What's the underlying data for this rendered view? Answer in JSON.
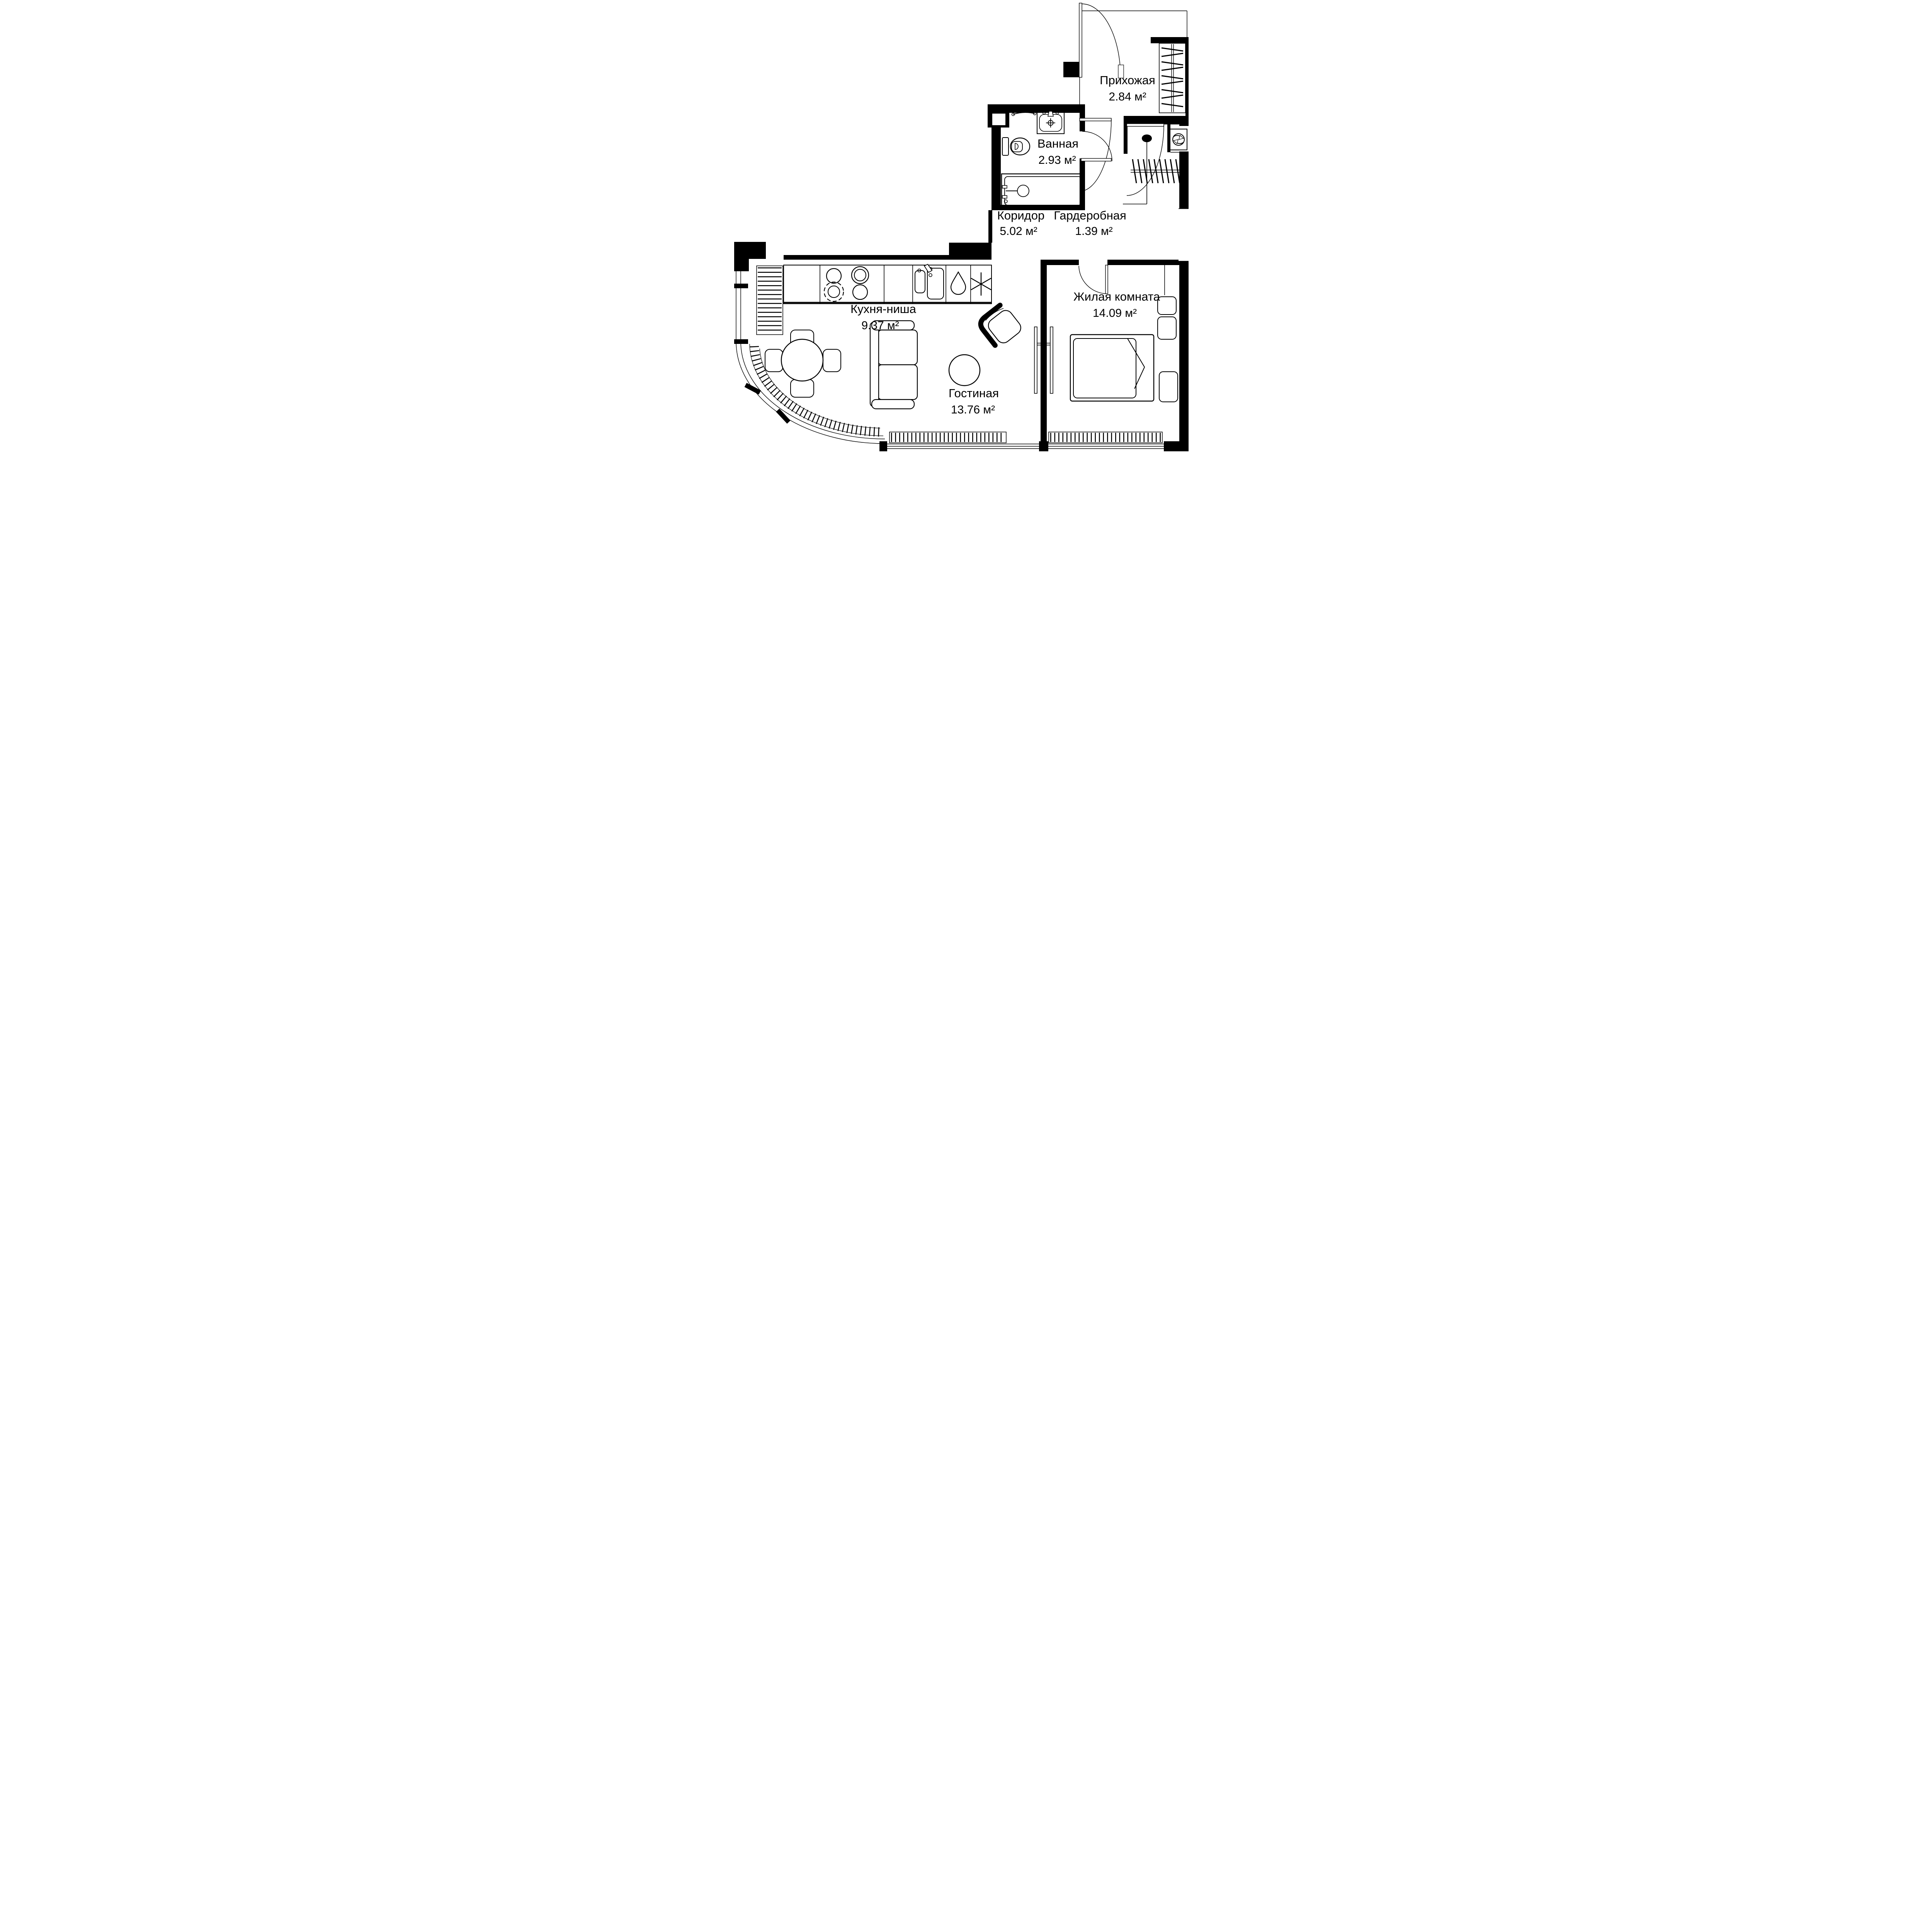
{
  "plan_type": "apartment-floor-plan",
  "language": "ru",
  "colors": {
    "walls": "#000000",
    "background": "#ffffff",
    "lines": "#000000"
  },
  "rooms": [
    {
      "id": "hallway",
      "name": "Прихожая",
      "area": "2.84 м²"
    },
    {
      "id": "bathroom",
      "name": "Ванная",
      "area": "2.93 м²"
    },
    {
      "id": "corridor",
      "name": "Коридор",
      "area": "5.02 м²"
    },
    {
      "id": "wardrobe",
      "name": "Гардеробная",
      "area": "1.39 м²"
    },
    {
      "id": "kitchen",
      "name": "Кухня-ниша",
      "area": "9.37 м²"
    },
    {
      "id": "living",
      "name": "Гостиная",
      "area": "13.76 м²"
    },
    {
      "id": "bedroom",
      "name": "Жилая комната",
      "area": "14.09 м²"
    }
  ],
  "fixtures": [
    "entrance-door",
    "coat-hanger-rack",
    "washbasin",
    "toilet",
    "bathtub",
    "towel-rail",
    "washing-machine",
    "wardrobe-hanger-rail",
    "kitchen-counter",
    "stove-burners",
    "kitchen-sink",
    "water-drop",
    "snowflake-fridge",
    "dining-table",
    "dining-chairs",
    "sofa",
    "coffee-table",
    "armchair",
    "sliding-door",
    "swing-doors",
    "double-bed",
    "nightstands",
    "radiators",
    "curved-glass-wall",
    "windows"
  ]
}
